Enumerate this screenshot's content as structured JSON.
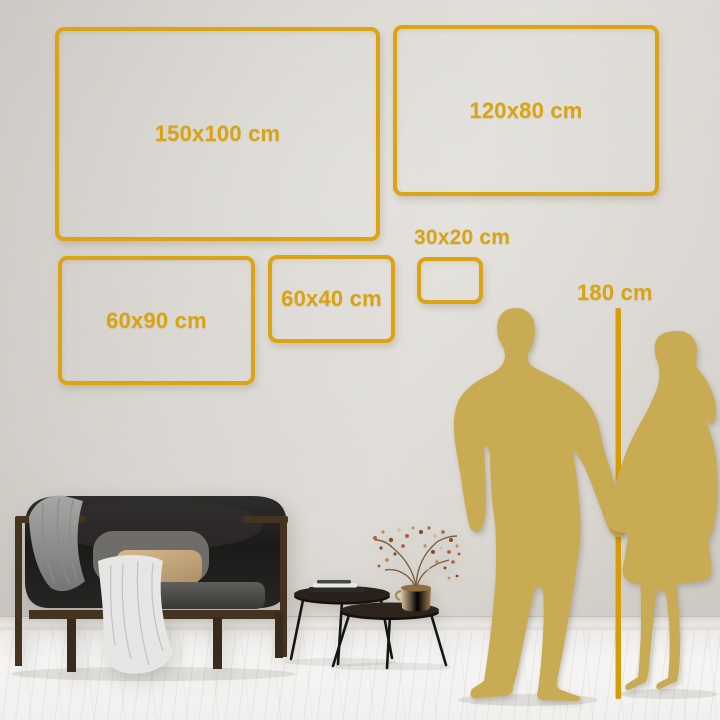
{
  "size_chart": {
    "frames": [
      {
        "label": "150x100 cm",
        "width_cm": 150,
        "height_cm": 100
      },
      {
        "label": "120x80 cm",
        "width_cm": 120,
        "height_cm": 80
      },
      {
        "label": "60x90 cm",
        "width_cm": 60,
        "height_cm": 90
      },
      {
        "label": "60x40 cm",
        "width_cm": 60,
        "height_cm": 40
      },
      {
        "label": "30x20 cm",
        "width_cm": 30,
        "height_cm": 20
      }
    ],
    "height_reference": {
      "label": "180 cm",
      "height_cm": 180
    }
  },
  "colors": {
    "accent_gold": "#dca413",
    "reference_line": "#d79c0a",
    "silhouette_gold": "#c9ab54",
    "wall": "#d8d4cf",
    "floor": "#f4f3f1"
  },
  "scene": {
    "silhouettes": [
      "man",
      "woman"
    ],
    "furniture": [
      "sofa",
      "gray-blanket",
      "white-throw",
      "gray-pillow",
      "beige-pillow",
      "nesting-coffee-tables",
      "books",
      "gold-vase",
      "dried-branch"
    ]
  }
}
